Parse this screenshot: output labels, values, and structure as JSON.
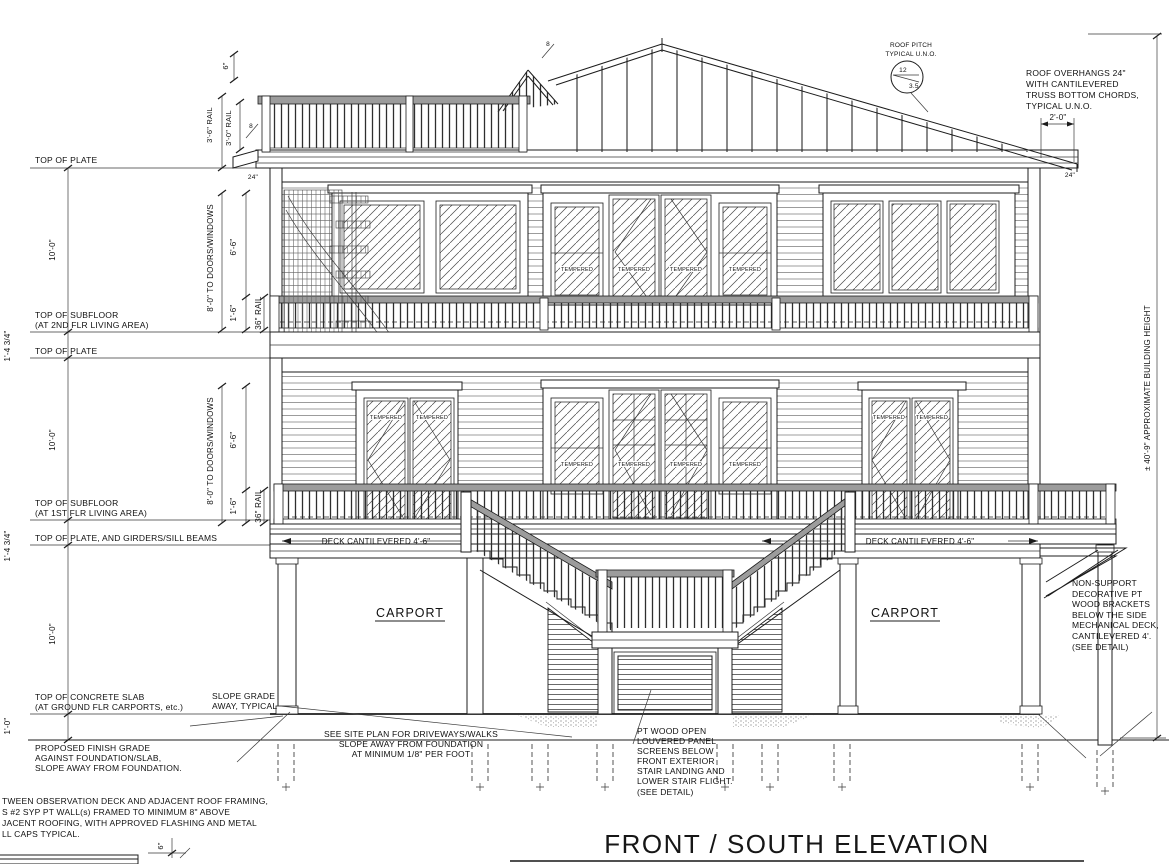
{
  "colors": {
    "line": "#1c1c1c",
    "background": "#ffffff",
    "rail_fill": "#9c9c9c"
  },
  "title": {
    "text": "FRONT / SOUTH ELEVATION"
  },
  "levels": {
    "plate3": "TOP OF PLATE",
    "subfloor2": "TOP OF SUBFLOOR",
    "subfloor2_sub": "(AT 2ND FLR LIVING AREA)",
    "plate2": "TOP OF PLATE",
    "subfloor1": "TOP OF SUBFLOOR",
    "subfloor1_sub": "(AT 1ST FLR LIVING AREA)",
    "plate1": "TOP OF PLATE, AND GIRDERS/SILL BEAMS",
    "slab": "TOP OF CONCRETE SLAB",
    "slab_sub": "(AT GROUND FLR CARPORTS, etc.)",
    "grade1": "PROPOSED FINISH GRADE",
    "grade2": "AGAINST FOUNDATION/SLAB,",
    "grade3": "SLOPE AWAY FROM FOUNDATION."
  },
  "dims": {
    "floor_height": "10'-0\"",
    "plate_band": "1'-4 3/4\"",
    "grade_depth": "1'-0\"",
    "doors_windows": "8'-0\" TO DOORS/WINDOWS",
    "six_six": "6'-6\"",
    "one_six": "1'-6\"",
    "rail36": "36\" RAIL",
    "six": "6\"",
    "rail_top_36": "3'-6\" RAIL",
    "rail_top_30": "3'-0\" RAIL",
    "twentyfour": "24\"",
    "two_feet": "2'-0\"",
    "eight": "8",
    "deck_cant": "DECK CANTILEVERED 4'-6\"",
    "building_height": "± 40'-9\" APPROXIMATE BUILDING HEIGHT",
    "detail_six": "6\""
  },
  "roof": {
    "pitch_label1": "ROOF PITCH",
    "pitch_label2": "TYPICAL U.N.O.",
    "pitch_rise": "12",
    "pitch_run": "3.5",
    "overhang": [
      "ROOF OVERHANGS 24\"",
      "WITH CANTILEVERED",
      "TRUSS BOTTOM CHORDS,",
      "TYPICAL U.N.O."
    ]
  },
  "labels": {
    "carport": "CARPORT",
    "tempered": "TEMPERED"
  },
  "notes": {
    "slope_grade1": "SLOPE GRADE",
    "slope_grade2": "AWAY, TYPICAL",
    "site": [
      "SEE SITE PLAN FOR DRIVEWAYS/WALKS",
      "SLOPE AWAY FROM FOUNDATION",
      "AT MINIMUM 1/8\" PER FOOT"
    ],
    "louver": [
      "PT WOOD OPEN",
      "LOUVERED PANEL",
      "SCREENS BELOW",
      "FRONT EXTERIOR",
      "STAIR LANDING AND",
      "LOWER STAIR FLIGHT.",
      "(SEE DETAIL)"
    ],
    "bracket": [
      "NON-SUPPORT",
      "DECORATIVE PT",
      "WOOD BRACKETS",
      "BELOW THE SIDE",
      "MECHANICAL DECK,",
      "CANTILEVERED 4'.",
      "(SEE DETAIL)"
    ],
    "bottom_left": [
      "TWEEN OBSERVATION DECK AND ADJACENT ROOF FRAMING,",
      "S #2 SYP PT WALL(s) FRAMED TO MINIMUM 8\" ABOVE",
      "JACENT ROOFING, WITH APPROVED FLASHING AND METAL",
      "LL CAPS TYPICAL."
    ]
  }
}
